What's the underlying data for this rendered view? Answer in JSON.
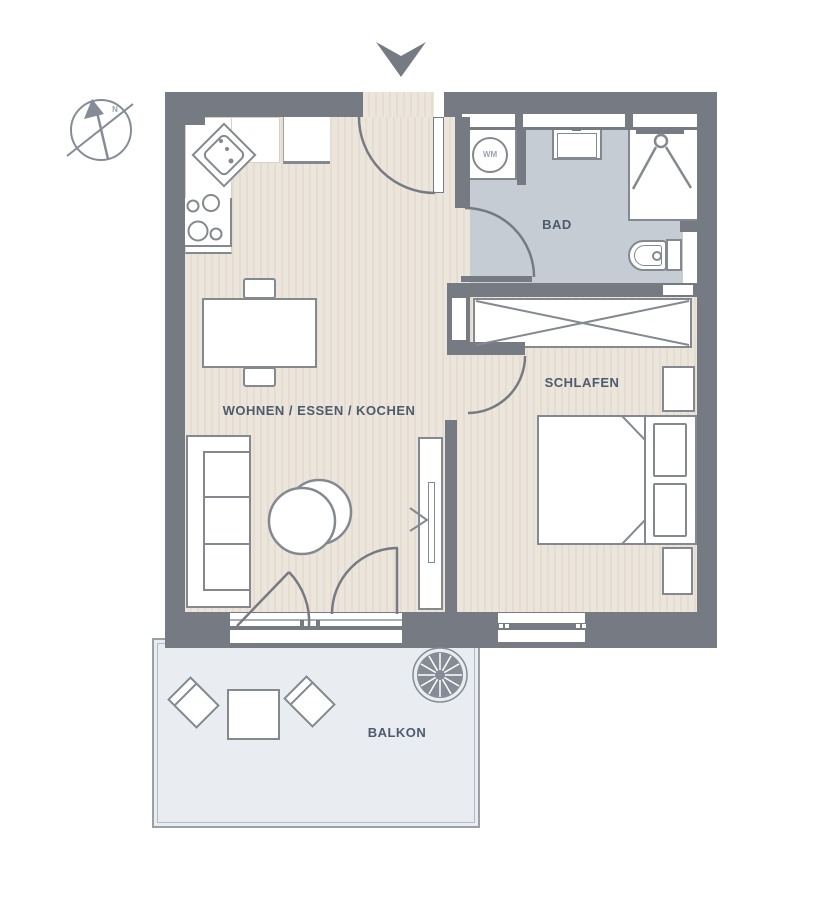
{
  "rooms": {
    "living": {
      "label": "WOHNEN / ESSEN / KOCHEN"
    },
    "bath": {
      "label": "BAD"
    },
    "bedroom": {
      "label": "SCHLAFEN"
    },
    "balcony": {
      "label": "BALKON"
    }
  },
  "markers": {
    "washing_machine": "WM",
    "compass_north": "N"
  },
  "icons": {
    "entrance_arrow": "entrance-arrow-icon",
    "compass": "north-compass-icon",
    "plant": "potted-plant-icon"
  },
  "colors": {
    "wall": "#767b83",
    "furniture_outline": "#84898f",
    "floor_living": "#ebe4da",
    "floor_bath": "#c6ccd4",
    "floor_balcony": "#e9edf2",
    "balcony_outline": "#9aa0a8",
    "label_text": "#4d5b6d"
  }
}
